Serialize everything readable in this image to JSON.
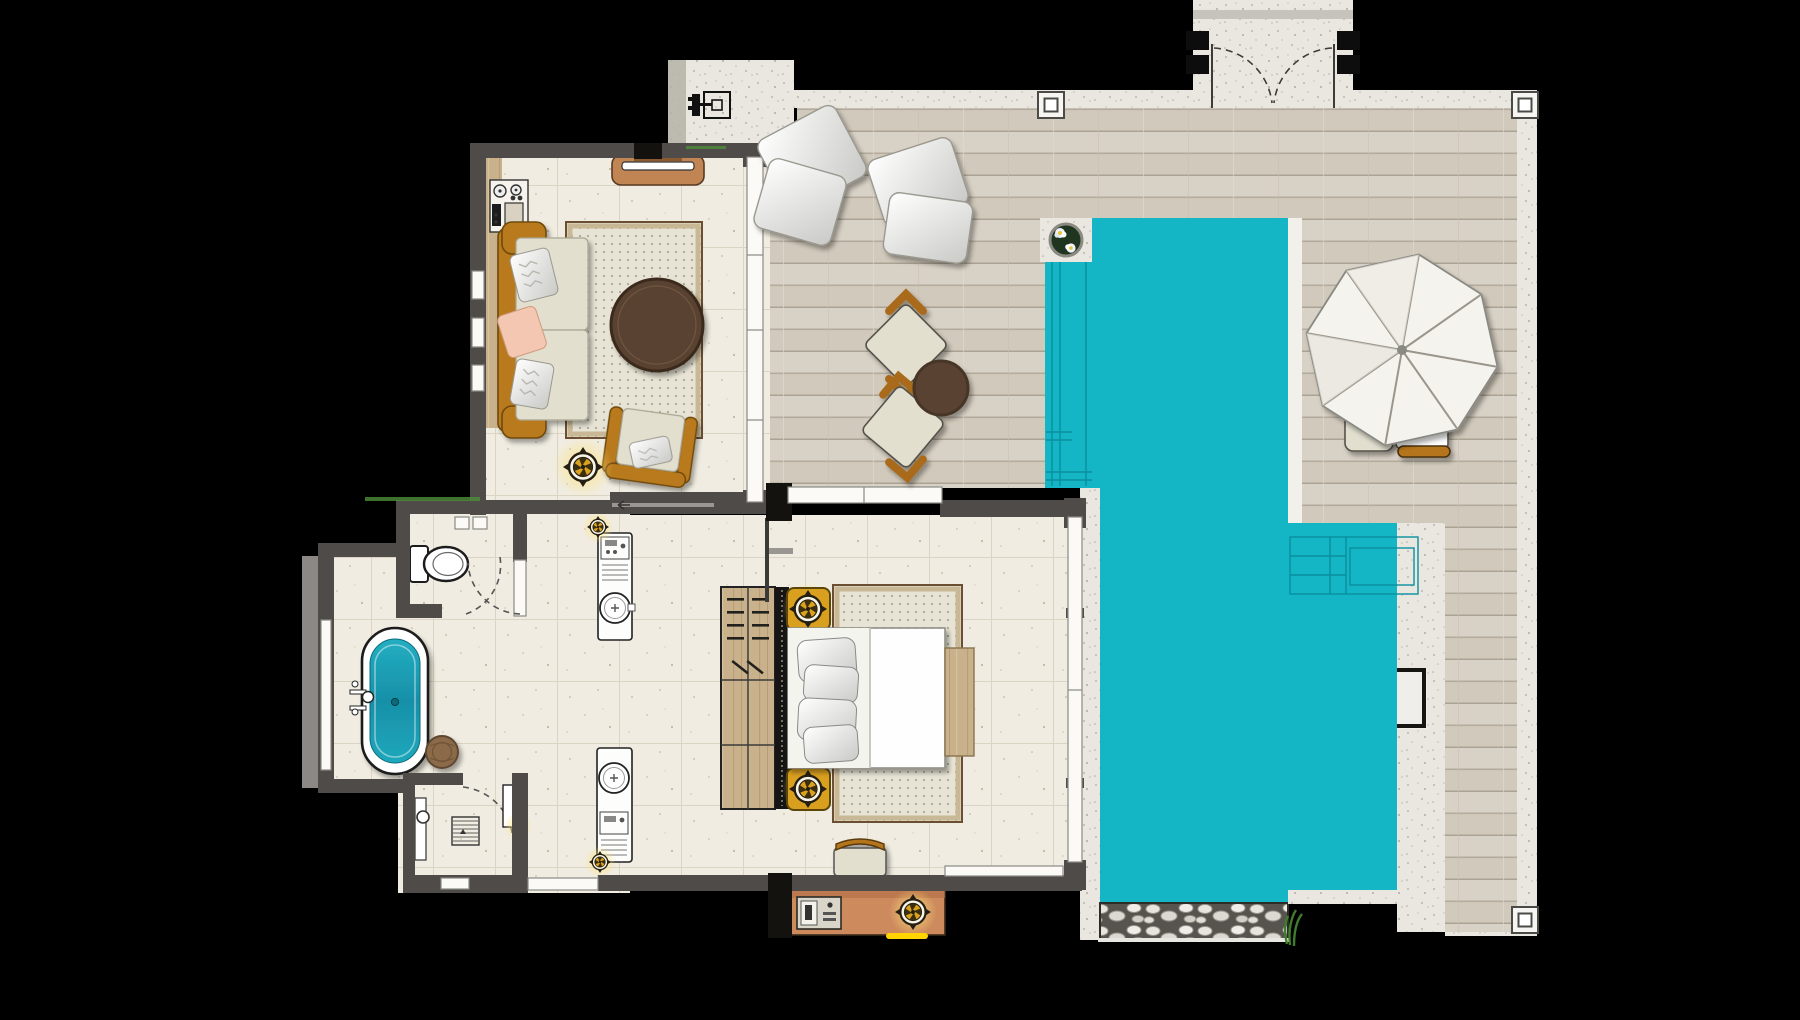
{
  "meta": {
    "description": "Top-down architectural floor plan of a one-bedroom pool villa with deck",
    "canvas": {
      "width": 1800,
      "height": 1020
    },
    "visible_text": "none"
  },
  "palette": {
    "background": "#000000",
    "wall": "#4f4b49",
    "wall_black": "#14120f",
    "wall_ledge": "#8b8885",
    "glass": "#fbfaf7",
    "glass_frame": "#8a8a84",
    "tile": "#f0ece1",
    "tile_grout": "#dbd4c2",
    "deck_board": "#d8d1c5",
    "deck_line": "#b3ab9c",
    "deck_edge": "#f2f0ea",
    "gravel": "#e9e7e0",
    "gravel_dark": "#b5b1a7",
    "pool": "#14b5c4",
    "pool_line": "#0a8fa0",
    "pebble_bed": "#57544f",
    "pebble": "#e8e5df",
    "wood": "#c9b28b",
    "wood_dark": "#a98f66",
    "sofa_frame": "#b87a1d",
    "cushion": "#e2dfcf",
    "pillow_pink": "#f3c7b1",
    "rug": "#e7e4d5",
    "rug_dot": "#aba793",
    "rug_tan": "#c9b896",
    "rug_brown": "#6b4f32",
    "table_brown": "#5a4330",
    "gold": "#d99f1f",
    "gold_dark": "#5d4708",
    "console": "#cd8a5d",
    "tub_water": "#1b9fb4",
    "stool": "#8a6a4a",
    "umbrella": "#f5f3ed",
    "umbrella_line": "#9a968c",
    "plant": "#3f7d2c",
    "glow": "#ffd84d",
    "highlight_yellow": "#ffd400"
  },
  "legend": {
    "rooms": [
      "living-room",
      "dressing-corridor",
      "bathroom",
      "wc-niche",
      "shower-room",
      "bedroom",
      "pool-deck",
      "swimming-pool",
      "entry-gate-path",
      "outdoor-pad"
    ],
    "furniture_icons": [
      "sofa",
      "armchair",
      "coffee-table",
      "tv-console",
      "minibar-counter",
      "ceiling-fan-icon",
      "vanity-sink",
      "bathtub",
      "toilet",
      "shower-drain",
      "wood-stool",
      "wardrobe-hangers",
      "double-bed",
      "nightstand-lamp",
      "bed-bench",
      "bed-side-platform",
      "media-console",
      "floor-pillows",
      "deck-lounge-chairs",
      "deck-side-table",
      "parasol",
      "sun-chairs",
      "pool-corner-planter",
      "pool-bench-steps",
      "pool-ladder-notch",
      "pebble-border",
      "corner-pillar",
      "gate-double-doors"
    ]
  }
}
